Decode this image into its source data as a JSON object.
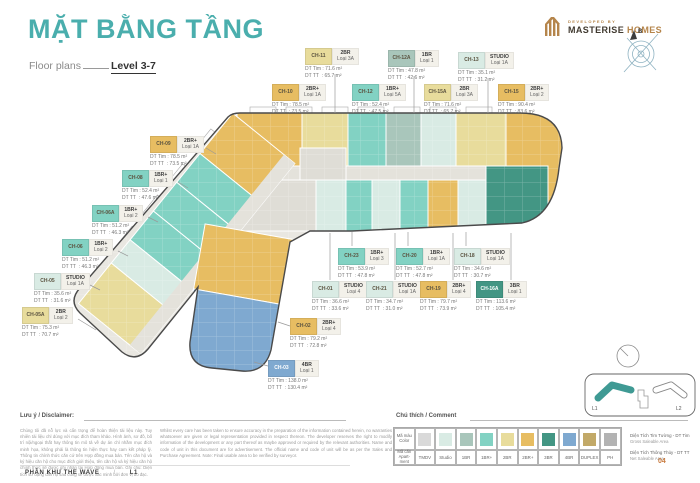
{
  "header": {
    "title": "MẶT BẰNG TẦNG",
    "subtitle_left": "Floor plans",
    "subtitle_right": "Level 3-7",
    "developed_by": "DEVELOPED BY",
    "brand_primary": "MASTERISE",
    "brand_secondary": "HOMES",
    "compass_label": "B"
  },
  "unit_categories": {
    "tmdv": "#d9d9d9",
    "studio": "#d9ebe4",
    "1br": "#a9c6bb",
    "1br_plus": "#82d2c3",
    "2br": "#e8dc9c",
    "2br_plus": "#e7bd62",
    "3br": "#439684",
    "4br": "#7fa9d0",
    "duplex": "#c2a968",
    "ph": "#b3b3b3"
  },
  "labels": {
    "dt_tim": "DT Tim",
    "dt_tt": "DT TT"
  },
  "plan": {
    "units": [
      {
        "code": "CH-10",
        "type": "2BR+",
        "loai": "Loại 1A",
        "tim": "78.5 m²",
        "tt": "73.5 m²",
        "cat": "2br_plus",
        "pos": [
          272,
          84
        ],
        "leader": null
      },
      {
        "code": "CH-11",
        "type": "2BR",
        "loai": "Loại 3A",
        "tim": "71.6 m²",
        "tt": "65.7 m²",
        "cat": "2br",
        "pos": [
          305,
          48
        ],
        "leader": [
          335,
          74,
          335,
          113
        ]
      },
      {
        "code": "CH-12",
        "type": "1BR+",
        "loai": "Loại 5A",
        "tim": "52.4 m²",
        "tt": "47.5 m²",
        "cat": "1br_plus",
        "pos": [
          352,
          84
        ],
        "leader": null
      },
      {
        "code": "CH-12A",
        "type": "1BR",
        "loai": "Loại 1",
        "tim": "47.8 m²",
        "tt": "42.6 m²",
        "cat": "1br",
        "pos": [
          388,
          50
        ],
        "leader": [
          414,
          76,
          414,
          113
        ]
      },
      {
        "code": "CH-13",
        "type": "STUDIO",
        "loai": "Loại 1A",
        "tim": "35.1 m²",
        "tt": "31.2 m²",
        "cat": "studio",
        "pos": [
          458,
          52
        ],
        "leader": [
          488,
          78,
          488,
          113
        ]
      },
      {
        "code": "CH-15A",
        "type": "2BR",
        "loai": "Loại 3A",
        "tim": "71.6 m²",
        "tt": "65.7 m²",
        "cat": "2br",
        "pos": [
          424,
          84
        ],
        "leader": null
      },
      {
        "code": "CH-15",
        "type": "2BR+",
        "loai": "Loại 2",
        "tim": "90.4 m²",
        "tt": "83.6 m²",
        "cat": "2br_plus",
        "pos": [
          498,
          84
        ],
        "leader": null
      },
      {
        "code": "CH-09",
        "type": "2BR+",
        "loai": "Loại 1A",
        "tim": "78.5 m²",
        "tt": "73.5 m²",
        "cat": "2br_plus",
        "pos": [
          150,
          136
        ],
        "leader": [
          206,
          148,
          216,
          154
        ]
      },
      {
        "code": "CH-08",
        "type": "1BR+",
        "loai": "Loại 1",
        "tim": "52.4 m²",
        "tt": "47.6 m²",
        "cat": "1br_plus",
        "pos": [
          122,
          170
        ],
        "leader": [
          178,
          182,
          188,
          188
        ]
      },
      {
        "code": "CH-06A",
        "type": "1BR+",
        "loai": "Loại 2",
        "tim": "51.2 m²",
        "tt": "46.3 m²",
        "cat": "1br_plus",
        "pos": [
          92,
          205
        ],
        "leader": [
          148,
          217,
          158,
          222
        ]
      },
      {
        "code": "CH-06",
        "type": "1BR+",
        "loai": "Loại 2",
        "tim": "51.2 m²",
        "tt": "46.3 m²",
        "cat": "1br_plus",
        "pos": [
          62,
          239
        ],
        "leader": [
          118,
          251,
          128,
          256
        ]
      },
      {
        "code": "CH-05",
        "type": "STUDIO",
        "loai": "Loại 1A",
        "tim": "35.6 m²",
        "tt": "31.6 m²",
        "cat": "studio",
        "pos": [
          34,
          273
        ],
        "leader": [
          90,
          285,
          100,
          290
        ]
      },
      {
        "code": "CH-05A",
        "type": "2BR",
        "loai": "Loại 2",
        "tim": "75.3 m²",
        "tt": "70.7 m²",
        "cat": "2br",
        "pos": [
          22,
          307
        ],
        "leader": [
          78,
          319,
          96,
          330
        ]
      },
      {
        "code": "CH-23",
        "type": "1BR+",
        "loai": "Loại 3",
        "tim": "53.9 m²",
        "tt": "47.8 m²",
        "cat": "1br_plus",
        "pos": [
          338,
          248
        ],
        "leader": [
          352,
          246,
          352,
          232
        ]
      },
      {
        "code": "CH-20",
        "type": "1BR+",
        "loai": "Loại 1A",
        "tim": "52.7 m²",
        "tt": "47.8 m²",
        "cat": "1br_plus",
        "pos": [
          396,
          248
        ],
        "leader": [
          408,
          246,
          408,
          232
        ]
      },
      {
        "code": "CH-18",
        "type": "STUDIO",
        "loai": "Loại 1A",
        "tim": "34.6 m²",
        "tt": "30.7 m²",
        "cat": "studio",
        "pos": [
          454,
          248
        ],
        "leader": [
          466,
          246,
          466,
          232
        ]
      },
      {
        "code": "CH-01",
        "type": "STUDIO",
        "loai": "Loại 4",
        "tim": "36.6 m²",
        "tt": "33.6 m²",
        "cat": "studio",
        "pos": [
          312,
          281
        ],
        "leader": [
          330,
          280,
          330,
          233
        ]
      },
      {
        "code": "CH-21",
        "type": "STUDIO",
        "loai": "Loại 1A",
        "tim": "34.7 m²",
        "tt": "31.0 m²",
        "cat": "studio",
        "pos": [
          366,
          281
        ],
        "leader": [
          395,
          280,
          395,
          233
        ]
      },
      {
        "code": "CH-19",
        "type": "2BR+",
        "loai": "Loại 4",
        "tim": "79.7 m²",
        "tt": "73.9 m²",
        "cat": "2br_plus",
        "pos": [
          420,
          281
        ],
        "leader": [
          453,
          280,
          453,
          233
        ]
      },
      {
        "code": "CH-16A",
        "type": "3BR",
        "loai": "Loại 1",
        "tim": "113.6 m²",
        "tt": "105.4 m²",
        "cat": "3br",
        "pos": [
          476,
          281
        ],
        "leader": [
          511,
          280,
          511,
          233
        ]
      },
      {
        "code": "CH-02",
        "type": "2BR+",
        "loai": "Loại 4",
        "tim": "79.2 m²",
        "tt": "72.8 m²",
        "cat": "2br_plus",
        "pos": [
          290,
          318
        ],
        "leader": [
          290,
          326,
          278,
          322
        ]
      },
      {
        "code": "CH-03",
        "type": "4BR",
        "loai": "Loại 1",
        "tim": "138.0 m²",
        "tt": "130.4 m²",
        "cat": "4br",
        "pos": [
          268,
          360
        ],
        "leader": [
          268,
          366,
          254,
          362
        ]
      }
    ]
  },
  "disclaimer": {
    "heading": "Lưu ý / Disclaimer:",
    "vi": "Chúng tôi đã nỗ lực và cẩn trọng để hoàn thiện tài liệu này. Tuy nhiên tài liệu chỉ dùng với mục đích tham khảo. Hình ảnh, sơ đồ, bố trí nội/ngoại thất hay thông tin mô tả về dự án chỉ nhằm mục đích minh họa, không phải là thông tin hiện thực hay cam kết pháp lý. Thông tin chính thức căn cứ trên Hợp đồng mua bán. Tên căn hộ và ký hiệu căn hộ cho mục đích giới thiệu, tên căn hộ và ký hiệu căn hộ chính thức sẽ được ghi nhận tại Hợp đồng mua bán. Ghi chú: Diện tích sử dụng căn hộ sau cùng sẽ được xác minh bởi đơn vị đo đạc.",
    "en": "Whilst every care has been taken to ensure accuracy in the preparation of the information contained herein, no warranties whatsoever are given or legal representation provided in respect thereon. The developer reserves the right to modify information of the development or any part thereof as maybe approved or required by the relevant authorities. Name and code of unit in this document are for advertisement. The official name and code of unit will be as per the Sales and Purchase Agreement. Note: Final usable area to be verified by surveyor."
  },
  "legend": {
    "heading": "Chú thích / Comment",
    "row1_label": "Mã màu\nColor",
    "row2_label": "Mã căn\nApart-\nment",
    "items": [
      {
        "label": "TMDV",
        "key": "tmdv"
      },
      {
        "label": "Studio",
        "key": "studio"
      },
      {
        "label": "1BR",
        "key": "1br"
      },
      {
        "label": "1BR+",
        "key": "1br_plus"
      },
      {
        "label": "2BR",
        "key": "2br"
      },
      {
        "label": "2BR+",
        "key": "2br_plus"
      },
      {
        "label": "3BR",
        "key": "3br"
      },
      {
        "label": "4BR",
        "key": "4br"
      },
      {
        "label": "DUPLEX",
        "key": "duplex"
      },
      {
        "label": "PH",
        "key": "ph"
      }
    ]
  },
  "legend_notes": [
    {
      "vi": "Diện Tích Tim Tường - DT Tim",
      "en": "Gross Saleable Area"
    },
    {
      "vi": "Diện Tích Thông Thủy - DT TT",
      "en": "Net Saleable Area"
    }
  ],
  "keyplan": {
    "l1": "L1",
    "l2": "L2"
  },
  "footer": {
    "zone": "PHÂN KHU THE WAVE",
    "separator": "/",
    "level": "L1",
    "page": "04"
  }
}
